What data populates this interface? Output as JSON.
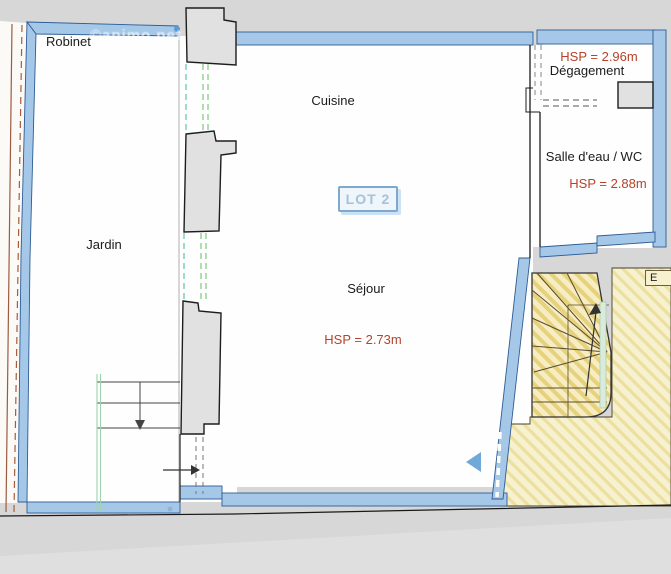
{
  "watermark": "©apimo.net",
  "labels": {
    "robinet": "Robinet",
    "cuisine": "Cuisine",
    "jardin": "Jardin",
    "sejour": "Séjour",
    "sejour_hsp": "HSP = 2.73m",
    "degagement": "Dégagement",
    "degagement_hsp": "HSP = 2.96m",
    "salle_eau": "Salle d'eau / WC",
    "salle_eau_hsp": "HSP = 2.88m",
    "lot_badge": "LOT 2",
    "stairwell": "E"
  },
  "colors": {
    "wall_blue": "#a6c8e8",
    "wall_blue_edge": "#2e5c94",
    "hsp_red": "#b5432a",
    "lot_text_blue": "#a9c0d6",
    "hatch_yellow": "#e7d686",
    "opening_green": "#7cc87c",
    "opening_teal": "#5ec4b0",
    "boundary_brown": "#a0522d",
    "plan_background": "#d7d7d7"
  }
}
